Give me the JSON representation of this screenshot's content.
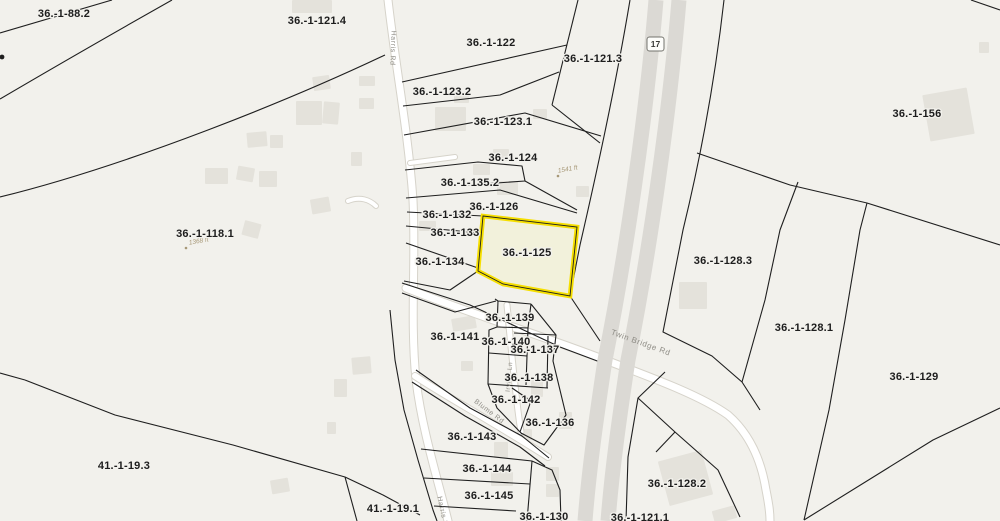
{
  "map": {
    "type": "cadastral-parcel-map",
    "highlighted_parcel": {
      "id": "36.-1-125",
      "outline_color": "#f6df00"
    },
    "route_shield": {
      "text": "17",
      "x": 647,
      "y": 37,
      "w": 17,
      "h": 14
    },
    "colors": {
      "background": "#f2f1ec",
      "boundary": "#1f1f1f",
      "road_fill": "#ffffff",
      "road_casing": "#d6d3ca",
      "highway": "#dbd9d4",
      "building": "#e4e2db",
      "highlight": "#f6df00",
      "label": "#1d1d1d",
      "road_label": "#8f8d86",
      "measurement": "#a79877"
    },
    "parcel_labels": [
      {
        "text": "36.-1-88.2",
        "x": 64,
        "y": 17
      },
      {
        "text": "36.-1-121.4",
        "x": 317,
        "y": 24
      },
      {
        "text": "36.-1-122",
        "x": 491,
        "y": 46
      },
      {
        "text": "36.-1-121.3",
        "x": 593,
        "y": 62
      },
      {
        "text": "36.-1-156",
        "x": 917,
        "y": 117
      },
      {
        "text": "36.-1-123.2",
        "x": 442,
        "y": 95
      },
      {
        "text": "36.-1-123.1",
        "x": 503,
        "y": 125
      },
      {
        "text": "36.-1-124",
        "x": 513,
        "y": 161
      },
      {
        "text": "36.-1-135.2",
        "x": 470,
        "y": 186
      },
      {
        "text": "36.-1-126",
        "x": 494,
        "y": 210
      },
      {
        "text": "36.-1-132",
        "x": 447,
        "y": 218
      },
      {
        "text": "36.-1-133",
        "x": 455,
        "y": 236
      },
      {
        "text": "36.-1-134",
        "x": 440,
        "y": 265
      },
      {
        "text": "36.-1-125",
        "x": 527,
        "y": 256
      },
      {
        "text": "36.-1-118.1",
        "x": 205,
        "y": 237
      },
      {
        "text": "36.-1-128.3",
        "x": 723,
        "y": 264
      },
      {
        "text": "36.-1-128.1",
        "x": 804,
        "y": 331
      },
      {
        "text": "36.-1-129",
        "x": 914,
        "y": 380
      },
      {
        "text": "36.-1-141",
        "x": 455,
        "y": 340
      },
      {
        "text": "36.-1-139",
        "x": 510,
        "y": 321
      },
      {
        "text": "36.-1-140",
        "x": 506,
        "y": 345
      },
      {
        "text": "36.-1-137",
        "x": 535,
        "y": 353
      },
      {
        "text": "36.-1-138",
        "x": 529,
        "y": 381
      },
      {
        "text": "36.-1-142",
        "x": 516,
        "y": 403
      },
      {
        "text": "36.-1-136",
        "x": 550,
        "y": 426
      },
      {
        "text": "36.-1-143",
        "x": 472,
        "y": 440
      },
      {
        "text": "36.-1-144",
        "x": 487,
        "y": 472
      },
      {
        "text": "36.-1-145",
        "x": 489,
        "y": 499
      },
      {
        "text": "36.-1-130",
        "x": 544,
        "y": 520
      },
      {
        "text": "41.-1-19.3",
        "x": 124,
        "y": 469
      },
      {
        "text": "41.-1-19.1",
        "x": 393,
        "y": 512
      },
      {
        "text": "36.-1-128.2",
        "x": 677,
        "y": 487
      },
      {
        "text": "36.-1-121.1",
        "x": 640,
        "y": 521
      }
    ],
    "road_labels": [
      {
        "text": "Harris Rd",
        "x": 391,
        "y": 48,
        "rot": 92,
        "size": 7
      },
      {
        "text": "Harris Rd",
        "x": 441,
        "y": 514,
        "rot": 78,
        "size": 7
      },
      {
        "text": "Twin Bridge Rd",
        "x": 640,
        "y": 345,
        "rot": 20,
        "size": 8
      },
      {
        "text": "Blume Rd",
        "x": 488,
        "y": 413,
        "rot": 37,
        "size": 7
      },
      {
        "text": "Irving Ln",
        "x": 511,
        "y": 377,
        "rot": -85,
        "size": 6.5
      }
    ],
    "measurements": [
      {
        "text": "1541 ft",
        "x": 568,
        "y": 171,
        "rot": -10,
        "dot": [
          558,
          176
        ]
      },
      {
        "text": "1368 ft",
        "x": 199,
        "y": 243,
        "rot": -10,
        "dot": [
          186,
          248
        ]
      }
    ],
    "highlight_polygon": "483,216 577,227 570,296 503,284 478,271",
    "roads": [
      {
        "name": "Harris Rd",
        "path": "M388,0 C396,70 408,130 413,200 C416,260 410,320 416,380 C422,430 438,480 448,521",
        "width": 7
      },
      {
        "name": "Twin Bridge Rd",
        "path": "M406,288 C460,310 540,335 600,358 C650,377 700,395 728,415 C752,436 762,465 766,490 C769,505 770,512 770,521",
        "width": 7
      },
      {
        "name": "Blume Rd",
        "path": "M415,376 C445,396 480,414 548,457",
        "width": 6
      },
      {
        "name": "Irving Ln",
        "path": "M507,305 C511,345 515,395 521,432",
        "width": 5
      },
      {
        "name": "driveway",
        "path": "M410,163 L455,157",
        "width": 4
      },
      {
        "name": "driveway",
        "path": "M348,201 C360,196 370,200 376,206",
        "width": 4
      }
    ],
    "highway": {
      "name": "NY-17",
      "strip_width": 15,
      "strips": [
        "M656,0 C646,120 625,260 605,360 C596,420 589,470 585,521",
        "M679,0 C669,120 648,260 628,360 C619,420 612,470 608,521"
      ]
    },
    "boundaries": [
      "M0,33 Q55,17 112,0",
      "M0,99 Q80,52 172,0",
      "M0,197 C130,165 290,100 385,55",
      "M578,0 L552,105",
      "M552,105 L600,143",
      "M630,0 C615,90 595,180 580,245 L570,296 L600,341",
      "M724,0 C715,80 700,160 683,230 L663,332 L712,356 L742,382 L760,410",
      "M697,153 L790,185 L867,203 L1000,245",
      "M798,182 L780,230 L765,300 L742,382",
      "M867,203 L860,230 L845,320 L829,410 L804,520",
      "M804,520 L933,440 L1000,408",
      "M665,372 L638,398 L628,457 L626,521",
      "M638,398 L675,432 L718,470 L740,517",
      "M675,432 L656,452",
      "M971,0 L1000,10",
      "M402,82 L567,45",
      "M403,106 L500,95 L559,72",
      "M404,135 L525,113 L601,136",
      "M405,170 L478,162 L522,166 L525,181 L468,185",
      "M525,181 L577,210",
      "M406,198 L500,190 L577,213",
      "M407,212 L483,216",
      "M406,226 L480,233",
      "M406,243 L478,268",
      "M404,281 L450,290 L478,271",
      "M402,283 L470,305 L560,347 L600,362",
      "M402,293 L455,312 L496,301",
      "M390,310 L395,360 L404,410 L418,460 L433,510 L437,521",
      "M416,370 L470,408 L522,436 L549,458",
      "M412,382 L465,416 L520,447 L545,466",
      "M495,299 L498,301 L531,304",
      "M498,301 L497,327 L489,330 L488,384 L497,408 L522,434",
      "M497,327 L528,328",
      "M531,304 L528,328 L527,356 L526,385",
      "M489,353 L527,356",
      "M488,384 L548,388",
      "M531,304 L556,335 L553,361 L559,386 L566,415 L544,445 L521,433",
      "M556,335 L514,333",
      "M548,336 L547,388",
      "M512,388 L531,401 L520,432",
      "M421,449 L532,461",
      "M424,478 L530,484",
      "M434,506 L516,511",
      "M532,461 L527,521",
      "M532,461 L552,470 L560,490 L561,521",
      "M25,380 L115,415 L233,445 L345,477 L383,495 L420,515",
      "M0,373 L25,380",
      "M345,477 L357,521"
    ],
    "dots": [
      {
        "x": 2,
        "y": 57,
        "r": 2.4
      }
    ],
    "buildings": [
      {
        "x": 292,
        "y": 0,
        "w": 40,
        "h": 13,
        "r": 0
      },
      {
        "x": 313,
        "y": 76,
        "w": 17,
        "h": 14,
        "r": -8
      },
      {
        "x": 359,
        "y": 76,
        "w": 16,
        "h": 10,
        "r": 0
      },
      {
        "x": 296,
        "y": 101,
        "w": 26,
        "h": 24,
        "r": 0
      },
      {
        "x": 323,
        "y": 102,
        "w": 16,
        "h": 22,
        "r": 5
      },
      {
        "x": 359,
        "y": 98,
        "w": 15,
        "h": 11,
        "r": 0
      },
      {
        "x": 247,
        "y": 132,
        "w": 20,
        "h": 15,
        "r": -5
      },
      {
        "x": 270,
        "y": 135,
        "w": 13,
        "h": 13,
        "r": 0
      },
      {
        "x": 205,
        "y": 168,
        "w": 23,
        "h": 16,
        "r": 0
      },
      {
        "x": 237,
        "y": 167,
        "w": 17,
        "h": 14,
        "r": 10
      },
      {
        "x": 259,
        "y": 171,
        "w": 18,
        "h": 16,
        "r": 0
      },
      {
        "x": 351,
        "y": 152,
        "w": 11,
        "h": 14,
        "r": 0
      },
      {
        "x": 311,
        "y": 198,
        "w": 19,
        "h": 15,
        "r": -10
      },
      {
        "x": 243,
        "y": 222,
        "w": 17,
        "h": 15,
        "r": 15
      },
      {
        "x": 454,
        "y": 92,
        "w": 15,
        "h": 11,
        "r": 0
      },
      {
        "x": 435,
        "y": 107,
        "w": 31,
        "h": 24,
        "r": 0
      },
      {
        "x": 533,
        "y": 109,
        "w": 14,
        "h": 10,
        "r": 0
      },
      {
        "x": 493,
        "y": 149,
        "w": 16,
        "h": 12,
        "r": 0
      },
      {
        "x": 473,
        "y": 164,
        "w": 17,
        "h": 11,
        "r": 0
      },
      {
        "x": 497,
        "y": 181,
        "w": 21,
        "h": 14,
        "r": 0
      },
      {
        "x": 576,
        "y": 186,
        "w": 13,
        "h": 11,
        "r": 0
      },
      {
        "x": 419,
        "y": 221,
        "w": 17,
        "h": 10,
        "r": 0
      },
      {
        "x": 452,
        "y": 317,
        "w": 24,
        "h": 13,
        "r": -10
      },
      {
        "x": 461,
        "y": 361,
        "w": 12,
        "h": 10,
        "r": 0
      },
      {
        "x": 531,
        "y": 379,
        "w": 12,
        "h": 18,
        "r": 0
      },
      {
        "x": 559,
        "y": 412,
        "w": 13,
        "h": 17,
        "r": 0
      },
      {
        "x": 519,
        "y": 429,
        "w": 13,
        "h": 11,
        "r": 0
      },
      {
        "x": 494,
        "y": 442,
        "w": 14,
        "h": 16,
        "r": 0
      },
      {
        "x": 491,
        "y": 472,
        "w": 22,
        "h": 14,
        "r": 0
      },
      {
        "x": 546,
        "y": 467,
        "w": 13,
        "h": 14,
        "r": 0
      },
      {
        "x": 546,
        "y": 484,
        "w": 13,
        "h": 13,
        "r": 0
      },
      {
        "x": 352,
        "y": 357,
        "w": 19,
        "h": 17,
        "r": -5
      },
      {
        "x": 334,
        "y": 379,
        "w": 13,
        "h": 18,
        "r": 0
      },
      {
        "x": 327,
        "y": 422,
        "w": 9,
        "h": 12,
        "r": 0
      },
      {
        "x": 271,
        "y": 479,
        "w": 18,
        "h": 14,
        "r": -10
      },
      {
        "x": 926,
        "y": 91,
        "w": 45,
        "h": 47,
        "r": -10
      },
      {
        "x": 679,
        "y": 282,
        "w": 28,
        "h": 27,
        "r": 0
      },
      {
        "x": 663,
        "y": 455,
        "w": 45,
        "h": 46,
        "r": -15
      },
      {
        "x": 713,
        "y": 508,
        "w": 23,
        "h": 13,
        "r": -15
      },
      {
        "x": 979,
        "y": 42,
        "w": 10,
        "h": 11,
        "r": 0
      }
    ]
  }
}
